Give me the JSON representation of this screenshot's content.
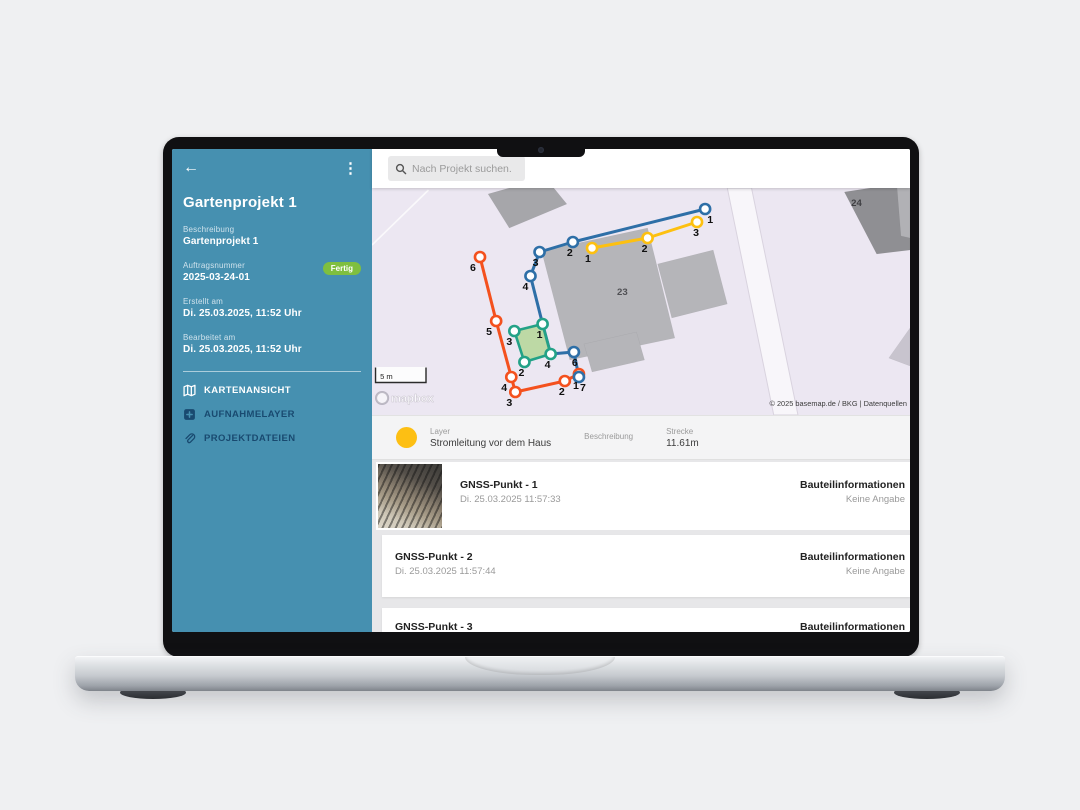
{
  "window": {
    "search_placeholder": "Nach Projekt suchen."
  },
  "sidebar": {
    "title": "Gartenprojekt 1",
    "badge": "Fertig",
    "badge_color": "#7fbf3f",
    "accent_color": "#4690b0",
    "fields": [
      {
        "label": "Beschreibung",
        "value": "Gartenprojekt 1"
      },
      {
        "label": "Auftragsnummer",
        "value": "2025-03-24-01"
      },
      {
        "label": "Erstellt am",
        "value": "Di. 25.03.2025, 11:52 Uhr"
      },
      {
        "label": "Bearbeitet am",
        "value": "Di. 25.03.2025, 11:52 Uhr"
      }
    ],
    "menu": [
      {
        "label": "KARTENANSICHT",
        "icon": "map-icon",
        "active": true
      },
      {
        "label": "AUFNAHMELAYER",
        "icon": "add-layer-icon",
        "active": false
      },
      {
        "label": "PROJEKTDATEIEN",
        "icon": "paperclip-icon",
        "active": false
      }
    ]
  },
  "layer_info": {
    "color": "#fdbf13",
    "layer_label": "Layer",
    "layer_value": "Stromleitung vor dem Haus",
    "description_label": "Beschreibung",
    "distance_label": "Strecke",
    "distance_value": "11.61m"
  },
  "list": {
    "rows": [
      {
        "title": "GNSS-Punkt - 1",
        "timestamp": "Di. 25.03.2025 11:57:33",
        "info_label": "Bauteilinformationen",
        "info_value": "Keine Angabe"
      },
      {
        "title": "GNSS-Punkt - 2",
        "timestamp": "Di. 25.03.2025 11:57:44",
        "info_label": "Bauteilinformationen",
        "info_value": "Keine Angabe"
      },
      {
        "title": "GNSS-Punkt - 3",
        "timestamp": "",
        "info_label": "Bauteilinformationen",
        "info_value": ""
      }
    ]
  },
  "map": {
    "bg": "#ece7f2",
    "scale_label": "5 m",
    "logo_text": "mapbox",
    "attribution": "© 2025 basemap.de / BKG | Datenquellen",
    "boundary_line": {
      "x1": 0,
      "y1": 57,
      "x2": 56,
      "y2": 2
    },
    "road": {
      "points": "352,0 376,0 422,227 398,227",
      "fill": "#f8f6fa",
      "stroke": "#d9d3df"
    },
    "buildings": [
      {
        "points": "115,6 172,-10 193,16 136,40",
        "fill": "#a6a6aa"
      },
      {
        "points": "168,63 273,40 300,150 196,172",
        "fill": "#b5b5b9"
      },
      {
        "points": "283,76 338,62 352,116 297,130",
        "fill": "#b5b5b9"
      },
      {
        "points": "210,156 262,144 270,172 218,184",
        "fill": "#b5b5b9"
      },
      {
        "points": "468,4 520,-4 533,46 533,62 500,66",
        "fill": "#8f8f93"
      },
      {
        "points": "520,-2 533,-6 533,50 524,48",
        "fill": "#b1b1b5"
      },
      {
        "points": "533,140 533,178 512,170",
        "fill": "#c8c4ce"
      }
    ],
    "building_labels": [
      {
        "t": "23",
        "x": 248,
        "y": 107,
        "fill": "#505054"
      },
      {
        "t": "24",
        "x": 480,
        "y": 18,
        "fill": "#3f3f43"
      }
    ],
    "layers": [
      {
        "name": "orange-line",
        "color": "#f4511e",
        "points": [
          [
            107,
            69
          ],
          [
            123,
            133
          ],
          [
            138,
            189
          ],
          [
            142,
            204
          ],
          [
            191,
            193
          ],
          [
            205,
            186
          ]
        ],
        "labels": [
          {
            "t": "6",
            "x": 100,
            "y": 83
          },
          {
            "t": "5",
            "x": 116,
            "y": 147
          },
          {
            "t": "4",
            "x": 131,
            "y": 203
          },
          {
            "t": "3",
            "x": 136,
            "y": 218
          },
          {
            "t": "2",
            "x": 188,
            "y": 207
          },
          {
            "t": "1",
            "x": 202,
            "y": 201
          }
        ]
      },
      {
        "name": "blue-line",
        "color": "#2e6fa7",
        "points": [
          [
            330,
            21
          ],
          [
            199,
            54
          ],
          [
            166,
            64
          ],
          [
            157,
            88
          ],
          [
            169,
            136
          ],
          [
            177,
            166
          ],
          [
            200,
            164
          ],
          [
            205,
            189
          ]
        ],
        "skip_markers": [
          4,
          5
        ],
        "labels": [
          {
            "t": "1",
            "x": 335,
            "y": 35
          },
          {
            "t": "2",
            "x": 196,
            "y": 68
          },
          {
            "t": "3",
            "x": 162,
            "y": 78
          },
          {
            "t": "4",
            "x": 152,
            "y": 102
          },
          {
            "t": "6",
            "x": 201,
            "y": 178
          },
          {
            "t": "7",
            "x": 209,
            "y": 203
          }
        ]
      },
      {
        "name": "yellow-line",
        "color": "#fdc010",
        "points": [
          [
            218,
            60
          ],
          [
            273,
            50
          ],
          [
            322,
            34
          ]
        ],
        "labels": [
          {
            "t": "1",
            "x": 214,
            "y": 74
          },
          {
            "t": "2",
            "x": 270,
            "y": 64
          },
          {
            "t": "3",
            "x": 321,
            "y": 48
          }
        ]
      }
    ],
    "polygon": {
      "name": "green-area",
      "color": "#23a287",
      "fill": "rgba(160,209,118,0.62)",
      "points": [
        [
          141,
          143
        ],
        [
          169,
          136
        ],
        [
          177,
          166
        ],
        [
          151,
          174
        ]
      ],
      "labels": [
        {
          "t": "3",
          "x": 136,
          "y": 157
        },
        {
          "t": "1",
          "x": 166,
          "y": 150
        },
        {
          "t": "4",
          "x": 174,
          "y": 180
        },
        {
          "t": "2",
          "x": 148,
          "y": 188
        }
      ]
    }
  }
}
